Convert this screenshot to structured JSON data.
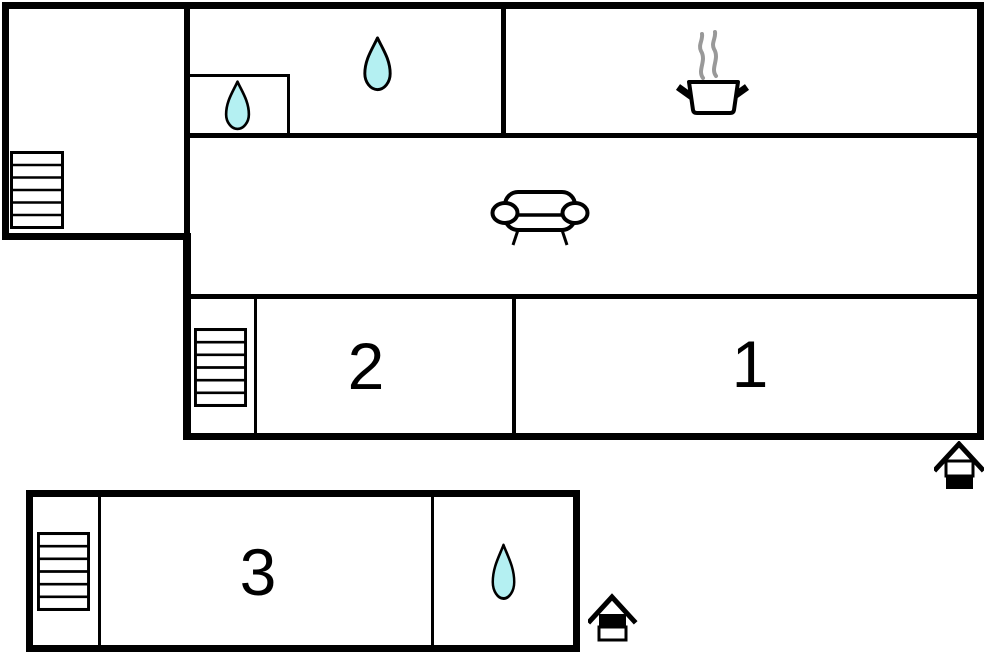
{
  "colors": {
    "wall": "#000000",
    "background": "#ffffff",
    "water_drop_fill": "#b4f0f2",
    "water_drop_outline": "#000000",
    "steam": "#999999"
  },
  "rooms": {
    "bedroom_1": {
      "label": "1"
    },
    "bedroom_2": {
      "label": "2"
    },
    "bedroom_3": {
      "label": "3"
    }
  },
  "icons": {
    "stairs": "stairs-icon",
    "water_drop": "water-drop-icon",
    "cooking_pot": "cooking-pot-icon",
    "sofa": "sofa-icon",
    "entrance": "entrance-house-icon"
  }
}
